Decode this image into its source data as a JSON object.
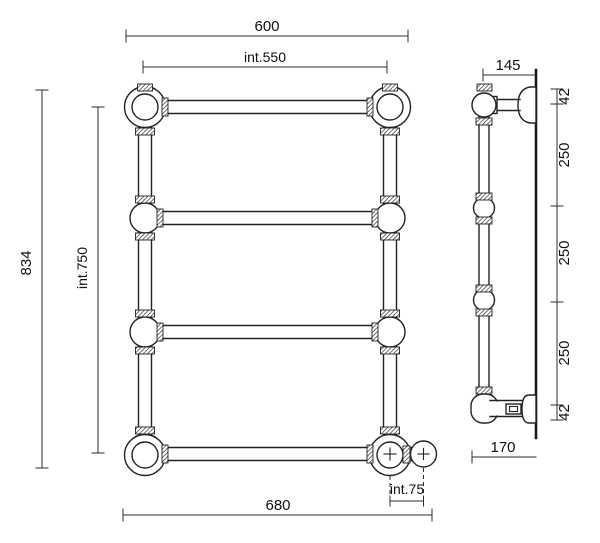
{
  "front_view": {
    "dim_width_top": "600",
    "dim_width_inner": "int.550",
    "dim_height_total": "834",
    "dim_height_inner": "int.750",
    "dim_width_bottom": "680",
    "dim_valve_spacing": "int.75"
  },
  "side_view": {
    "dim_depth_top": "145",
    "dim_depth_bottom": "170",
    "dim_segments": [
      "42",
      "250",
      "250",
      "250",
      "42"
    ]
  },
  "colors": {
    "line": "#222222",
    "dimension": "#2e2e2e",
    "background": "#ffffff"
  }
}
